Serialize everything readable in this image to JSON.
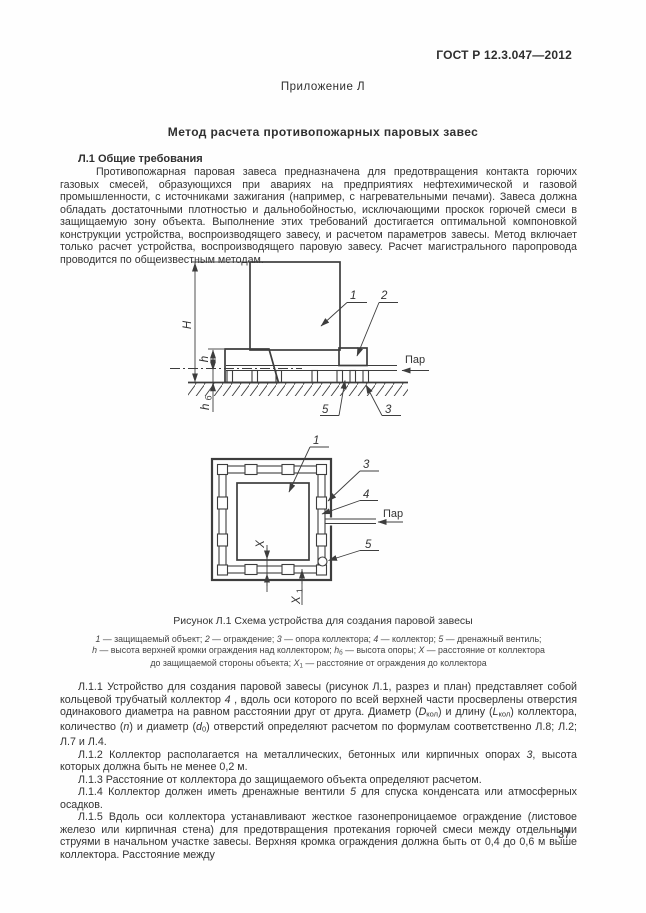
{
  "colors": {
    "ink": "#2f2f2f",
    "line": "#3d3d3d",
    "background": "#fefefe"
  },
  "header": {
    "standard_ref": "ГОСТ Р 12.3.047—2012",
    "appendix": "Приложение Л"
  },
  "title": "Метод расчета противопожарных паровых завес",
  "section_heading": "Л.1 Общие требования",
  "intro": "Противопожарная паровая завеса предназначена для предотвращения контакта горючих газовых смесей, образующихся при авариях на предприятиях нефтехимической и газовой промышленности, с источниками зажигания (например, с нагревательными печами). Завеса должна обладать достаточными плотностью и дальнобойностью, исключающими проскок горючей смеси в защищаемую зону объекта. Выполнение этих требований достигается оптимальной компоновкой конструкции устройства, воспроизводящего завесу, и расчетом параметров завесы. Метод включает только расчет устройства, воспроизводящего паровую завесу. Расчет магистрального паропровода проводится по общеизвестным методам.",
  "figure": {
    "caption": "Рисунок Л.1 Схема устройства для создания паровой завесы",
    "legend": [
      [
        {
          "t": "1",
          "f": "i"
        },
        {
          "t": " — защищаемый объект; "
        },
        {
          "t": "2",
          "f": "i"
        },
        {
          "t": " — ограждение; "
        },
        {
          "t": "3",
          "f": "i"
        },
        {
          "t": " — опора коллектора; "
        },
        {
          "t": "4",
          "f": "i"
        },
        {
          "t": " — коллектор; "
        },
        {
          "t": "5",
          "f": "i"
        },
        {
          "t": " — дренажный вентиль;"
        }
      ],
      [
        {
          "t": "h",
          "f": "i"
        },
        {
          "t": " — высота верхней кромки ограждения над коллектором; "
        },
        {
          "t": "h",
          "f": "i"
        },
        {
          "t": "б",
          "f": "sub"
        },
        {
          "t": " — высота опоры; "
        },
        {
          "t": "X",
          "f": "i"
        },
        {
          "t": " — расстояние от коллектора"
        }
      ],
      [
        {
          "t": "до защищаемой стороны объекта; "
        },
        {
          "t": "X",
          "f": "i"
        },
        {
          "t": "1",
          "f": "sub"
        },
        {
          "t": " — расстояние от ограждения до коллектора"
        }
      ]
    ],
    "side_view": {
      "label_object": "1",
      "label_fence": "2",
      "label_support": "3",
      "label_valve": "5",
      "dim_height": "H",
      "dim_fence_h": "h",
      "dim_support_base": "h",
      "dim_support_sub": "б",
      "steam": "Пар"
    },
    "plan_view": {
      "label_object": "1",
      "label_support": "3",
      "label_collector": "4",
      "label_valve": "5",
      "dim_x": "X",
      "dim_x1_base": "X",
      "dim_x1_sub": "1",
      "steam": "Пар"
    }
  },
  "paragraphs": [
    [
      {
        "t": "Л.1.1 Устройство для создания паровой завесы (рисунок Л.1, разрез и план) представляет собой кольцевой трубчатый коллектор "
      },
      {
        "t": "4",
        "f": "i"
      },
      {
        "t": " , вдоль оси которого по всей верхней части просверлены отверстия одинакового диаметра на равном расстоянии друг от друга. Диаметр ("
      },
      {
        "t": "D",
        "f": "i"
      },
      {
        "t": "кол",
        "f": "sub"
      },
      {
        "t": ") и длину ("
      },
      {
        "t": "L",
        "f": "i"
      },
      {
        "t": "кол",
        "f": "sub"
      },
      {
        "t": ") коллектора, количество ("
      },
      {
        "t": "n",
        "f": "i"
      },
      {
        "t": ")  и диаметр ("
      },
      {
        "t": "d",
        "f": "i"
      },
      {
        "t": "0",
        "f": "sub"
      },
      {
        "t": ") отверстий определяют расчетом по формулам соответственно Л.8; Л.2; Л.7 и Л.4."
      }
    ],
    [
      {
        "t": "Л.1.2 Коллектор располагается на металлических, бетонных или кирпичных опорах "
      },
      {
        "t": "3",
        "f": "i"
      },
      {
        "t": ", высота которых должна быть не менее 0,2 м."
      }
    ],
    [
      {
        "t": "Л.1.3 Расстояние от коллектора до защищаемого объекта определяют расчетом."
      }
    ],
    [
      {
        "t": "Л.1.4 Коллектор должен иметь дренажные вентили "
      },
      {
        "t": "5",
        "f": "i"
      },
      {
        "t": " для спуска конденсата или атмосферных осадков."
      }
    ],
    [
      {
        "t": "Л.1.5 Вдоль оси коллектора устанавливают жесткое газонепроницаемое ограждение (листовое железо или кирпичная стена) для предотвращения протекания горючей смеси между отдельными струями в начальном участке завесы. Верхняя кромка ограждения должна быть от 0,4 до 0,6 м выше коллектора. Расстояние между"
      }
    ]
  ],
  "page_number": "37"
}
